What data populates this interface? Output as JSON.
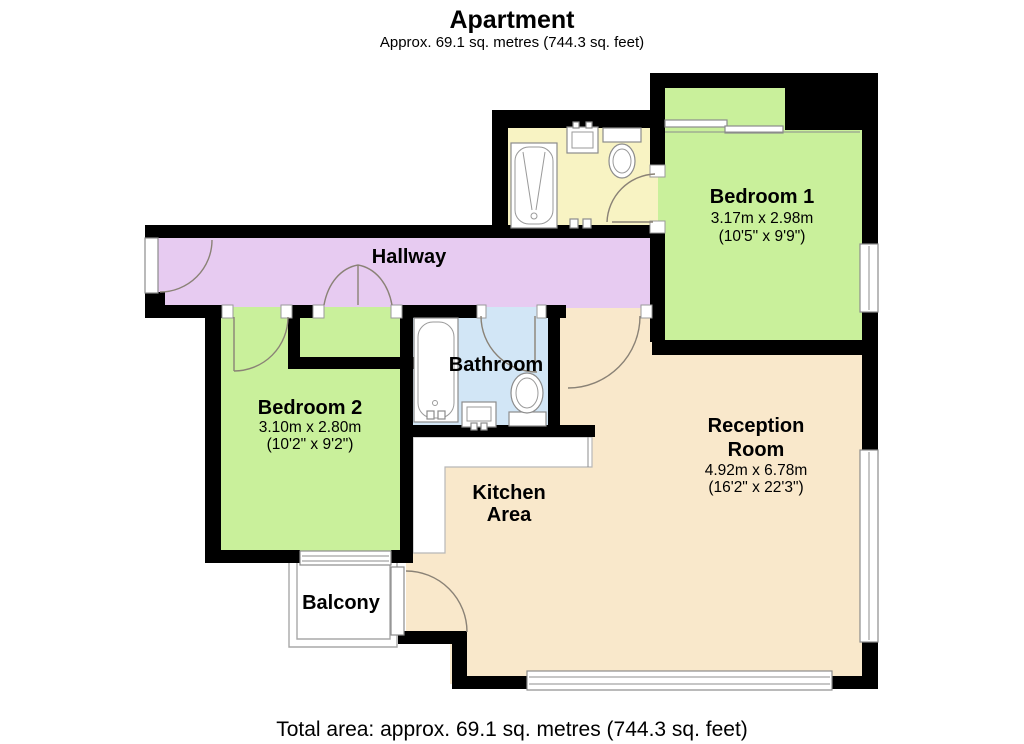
{
  "header": {
    "title": "Apartment",
    "subtitle": "Approx. 69.1 sq. metres (744.3 sq. feet)"
  },
  "footer": {
    "total_area": "Total area: approx. 69.1 sq. metres (744.3 sq. feet)"
  },
  "rooms": {
    "hallway": {
      "name": "Hallway"
    },
    "bedroom1": {
      "name": "Bedroom 1",
      "size_metric": "3.17m x 2.98m",
      "size_imperial": "(10'5\" x 9'9\")"
    },
    "bedroom2": {
      "name": "Bedroom 2",
      "size_metric": "3.10m x 2.80m",
      "size_imperial": "(10'2\" x 9'2\")"
    },
    "bathroom": {
      "name": "Bathroom"
    },
    "ensuite": {
      "name": ""
    },
    "reception": {
      "name_line1": "Reception",
      "name_line2": "Room",
      "size_metric": "4.92m x 6.78m",
      "size_imperial": "(16'2\" x 22'3\")"
    },
    "kitchen": {
      "name_line1": "Kitchen",
      "name_line2": "Area"
    },
    "balcony": {
      "name": "Balcony"
    }
  },
  "colors": {
    "bedroom_green": "#c9f09b",
    "hallway_purple": "#e7cbf1",
    "ensuite_yellow": "#f8f3c3",
    "bathroom_blue": "#d2e6f6",
    "reception_beige": "#f9e8cb",
    "wall_black": "#000000"
  }
}
